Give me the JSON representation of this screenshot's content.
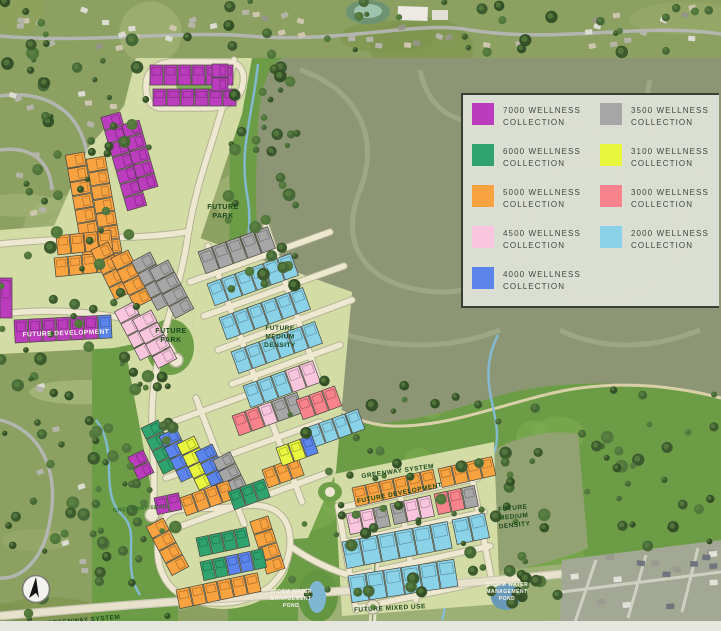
{
  "legend": {
    "items": [
      {
        "line1": "7000 WELLNESS",
        "line2": "COLLECTION",
        "color": "#bb3cbd"
      },
      {
        "line1": "6000 WELLNESS",
        "line2": "COLLECTION",
        "color": "#2fa36e"
      },
      {
        "line1": "5000 WELLNESS",
        "line2": "COLLECTION",
        "color": "#f9a240"
      },
      {
        "line1": "4500 WELLNESS",
        "line2": "COLLECTION",
        "color": "#f9c6de"
      },
      {
        "line1": "4000 WELLNESS",
        "line2": "COLLECTION",
        "color": "#5b85ec"
      },
      {
        "line1": "3500 WELLNESS",
        "line2": "COLLECTION",
        "color": "#a6a6a6"
      },
      {
        "line1": "3100 WELLNESS",
        "line2": "COLLECTION",
        "color": "#e8f73d"
      },
      {
        "line1": "3000 WELLNESS",
        "line2": "COLLECTION",
        "color": "#f9838c"
      },
      {
        "line1": "2000 WELLNESS",
        "line2": "COLLECTION",
        "color": "#8ad2e8"
      }
    ]
  },
  "map": {
    "palette": {
      "M": "#bb3cbd",
      "G": "#2fa36e",
      "O": "#f9a240",
      "P": "#f9c6de",
      "B": "#5b85ec",
      "A": "#a6a6a6",
      "Y": "#e8f73d",
      "S": "#f9838c",
      "C": "#8ad2e8"
    },
    "labels": [
      {
        "text": "FUTURE\nPARK",
        "x": 223,
        "y": 209,
        "size": 7,
        "color": "#1c4a1f",
        "rot": 0
      },
      {
        "text": "FUTURE\nPARK",
        "x": 171,
        "y": 333,
        "size": 7,
        "color": "#1c4a1f",
        "rot": 0
      },
      {
        "text": "FUTURE\nMEDIUM\nDENSITY",
        "x": 280,
        "y": 330,
        "size": 6.5,
        "color": "#1c4a1f",
        "rot": 0
      },
      {
        "text": "FUTURE DEVELOPMENT",
        "x": 66,
        "y": 335,
        "size": 6.5,
        "color": "#f7f4ee",
        "rot": -2
      },
      {
        "text": "GREENWAY SYSTEM",
        "x": 398,
        "y": 473,
        "size": 6.5,
        "color": "#1c4a1f",
        "rot": -8
      },
      {
        "text": "FUTURE DEVELOPMENT",
        "x": 400,
        "y": 495,
        "size": 6.5,
        "color": "#1c4a1f",
        "rot": -11
      },
      {
        "text": "FUTURE\nMEDIUM\nDENSITY",
        "x": 513,
        "y": 510,
        "size": 6.5,
        "color": "#1c4a1f",
        "rot": -6
      },
      {
        "text": "GREENWAY TRAIL",
        "x": 141,
        "y": 510,
        "size": 5.5,
        "color": "#2f6a2a",
        "rot": -4
      },
      {
        "text": "GREENWAY SYSTEM",
        "x": 84,
        "y": 622,
        "size": 6.5,
        "color": "#1c4a1f",
        "rot": -5
      },
      {
        "text": "STORM WATER\nMANAGEMENT\nPOND",
        "x": 291,
        "y": 593,
        "size": 5,
        "color": "#f7f4ee",
        "rot": 0
      },
      {
        "text": "FUTURE MIXED USE",
        "x": 390,
        "y": 610,
        "size": 6.5,
        "color": "#1c4a1f",
        "rot": -3
      },
      {
        "text": "STORM WATER\nMANAGEMENT\nPOND",
        "x": 507,
        "y": 586,
        "size": 5,
        "color": "#f7f4ee",
        "rot": 0
      }
    ],
    "strips": [
      {
        "x": 150,
        "y": 65,
        "a": 0,
        "n": 6,
        "w": 13,
        "h": 20,
        "c": [
          "M"
        ]
      },
      {
        "x": 153,
        "y": 89,
        "a": 0,
        "n": 6,
        "w": 13,
        "h": 17,
        "c": [
          "M"
        ]
      },
      {
        "x": 228,
        "y": 64,
        "a": 90,
        "n": 2,
        "w": 13,
        "h": 16,
        "c": [
          "M"
        ]
      },
      {
        "x": 120,
        "y": 112,
        "a": 74,
        "n": 7,
        "w": 13,
        "h": 20,
        "c": [
          "M"
        ]
      },
      {
        "x": 139,
        "y": 120,
        "a": 74,
        "n": 5,
        "w": 13,
        "h": 18,
        "c": [
          "M"
        ]
      },
      {
        "x": 84,
        "y": 152,
        "a": 80,
        "n": 8,
        "w": 13,
        "h": 19,
        "c": [
          "O"
        ]
      },
      {
        "x": 105,
        "y": 156,
        "a": 80,
        "n": 8,
        "w": 13,
        "h": 19,
        "c": [
          "O"
        ]
      },
      {
        "x": 56,
        "y": 236,
        "a": -6,
        "n": 4,
        "w": 13,
        "h": 19,
        "c": [
          "O"
        ]
      },
      {
        "x": 54,
        "y": 258,
        "a": -6,
        "n": 4,
        "w": 13,
        "h": 19,
        "c": [
          "O"
        ]
      },
      {
        "x": 108,
        "y": 242,
        "a": 64,
        "n": 4,
        "w": 13,
        "h": 19,
        "c": [
          "O"
        ]
      },
      {
        "x": 128,
        "y": 250,
        "a": 64,
        "n": 4,
        "w": 13,
        "h": 19,
        "c": [
          "O"
        ]
      },
      {
        "x": 14,
        "y": 320,
        "a": -3,
        "n": 7,
        "w": 13,
        "h": 23,
        "c": [
          "M",
          "M",
          "M",
          "M",
          "M",
          "M",
          "B"
        ]
      },
      {
        "x": 0,
        "y": 278,
        "a": 0,
        "n": 1,
        "w": 12,
        "h": 40,
        "c": [
          "M"
        ]
      },
      {
        "x": 150,
        "y": 252,
        "a": 62,
        "n": 4,
        "w": 13,
        "h": 21,
        "c": [
          "A"
        ]
      },
      {
        "x": 168,
        "y": 260,
        "a": 62,
        "n": 4,
        "w": 13,
        "h": 21,
        "c": [
          "A"
        ]
      },
      {
        "x": 133,
        "y": 302,
        "a": 62,
        "n": 4,
        "w": 13,
        "h": 21,
        "c": [
          "P"
        ]
      },
      {
        "x": 151,
        "y": 310,
        "a": 62,
        "n": 4,
        "w": 13,
        "h": 21,
        "c": [
          "P"
        ]
      },
      {
        "x": 198,
        "y": 252,
        "a": -20,
        "n": 5,
        "w": 14,
        "h": 23,
        "c": [
          "A"
        ]
      },
      {
        "x": 207,
        "y": 284,
        "a": -20,
        "n": 6,
        "w": 14,
        "h": 23,
        "c": [
          "C"
        ]
      },
      {
        "x": 219,
        "y": 318,
        "a": -20,
        "n": 6,
        "w": 14,
        "h": 23,
        "c": [
          "C"
        ]
      },
      {
        "x": 231,
        "y": 352,
        "a": -20,
        "n": 6,
        "w": 14,
        "h": 23,
        "c": [
          "C"
        ]
      },
      {
        "x": 243,
        "y": 386,
        "a": -20,
        "n": 5,
        "w": 14,
        "h": 23,
        "c": [
          "C",
          "C",
          "C",
          "P",
          "P"
        ]
      },
      {
        "x": 232,
        "y": 416,
        "a": -20,
        "n": 5,
        "w": 13,
        "h": 21,
        "c": [
          "S",
          "S",
          "P",
          "A",
          "A"
        ]
      },
      {
        "x": 296,
        "y": 400,
        "a": -20,
        "n": 3,
        "w": 13,
        "h": 21,
        "c": [
          "S"
        ]
      },
      {
        "x": 306,
        "y": 428,
        "a": -20,
        "n": 4,
        "w": 13,
        "h": 21,
        "c": [
          "C"
        ]
      },
      {
        "x": 158,
        "y": 420,
        "a": 64,
        "n": 4,
        "w": 12,
        "h": 19,
        "c": [
          "G"
        ]
      },
      {
        "x": 176,
        "y": 428,
        "a": 64,
        "n": 4,
        "w": 12,
        "h": 19,
        "c": [
          "B"
        ]
      },
      {
        "x": 194,
        "y": 436,
        "a": 64,
        "n": 4,
        "w": 12,
        "h": 19,
        "c": [
          "Y"
        ]
      },
      {
        "x": 212,
        "y": 444,
        "a": 64,
        "n": 4,
        "w": 12,
        "h": 19,
        "c": [
          "B"
        ]
      },
      {
        "x": 230,
        "y": 452,
        "a": 64,
        "n": 4,
        "w": 12,
        "h": 19,
        "c": [
          "A"
        ]
      },
      {
        "x": 143,
        "y": 450,
        "a": 64,
        "n": 2,
        "w": 12,
        "h": 17,
        "c": [
          "M"
        ]
      },
      {
        "x": 180,
        "y": 498,
        "a": -20,
        "n": 4,
        "w": 12,
        "h": 19,
        "c": [
          "O"
        ]
      },
      {
        "x": 228,
        "y": 492,
        "a": -20,
        "n": 3,
        "w": 12,
        "h": 19,
        "c": [
          "G"
        ]
      },
      {
        "x": 262,
        "y": 470,
        "a": -20,
        "n": 3,
        "w": 12,
        "h": 19,
        "c": [
          "O"
        ]
      },
      {
        "x": 276,
        "y": 448,
        "a": -20,
        "n": 3,
        "w": 12,
        "h": 19,
        "c": [
          "Y",
          "Y",
          "B"
        ]
      },
      {
        "x": 163,
        "y": 518,
        "a": 62,
        "n": 4,
        "w": 13,
        "h": 19,
        "c": [
          "O"
        ]
      },
      {
        "x": 176,
        "y": 590,
        "a": -12,
        "n": 6,
        "w": 13,
        "h": 19,
        "c": [
          "O"
        ]
      },
      {
        "x": 268,
        "y": 516,
        "a": 72,
        "n": 4,
        "w": 13,
        "h": 19,
        "c": [
          "O"
        ]
      },
      {
        "x": 196,
        "y": 538,
        "a": -12,
        "n": 4,
        "w": 12,
        "h": 19,
        "c": [
          "G"
        ]
      },
      {
        "x": 200,
        "y": 562,
        "a": -12,
        "n": 5,
        "w": 12,
        "h": 19,
        "c": [
          "G",
          "G",
          "B",
          "B",
          "G"
        ]
      },
      {
        "x": 154,
        "y": 498,
        "a": -12,
        "n": 2,
        "w": 12,
        "h": 17,
        "c": [
          "M"
        ]
      },
      {
        "x": 352,
        "y": 488,
        "a": -13,
        "n": 6,
        "w": 13,
        "h": 19,
        "c": [
          "O"
        ]
      },
      {
        "x": 438,
        "y": 469,
        "a": -13,
        "n": 4,
        "w": 13,
        "h": 19,
        "c": [
          "O"
        ]
      },
      {
        "x": 346,
        "y": 514,
        "a": -12,
        "n": 3,
        "w": 13,
        "h": 21,
        "c": [
          "P",
          "P",
          "A"
        ]
      },
      {
        "x": 390,
        "y": 504,
        "a": -12,
        "n": 3,
        "w": 13,
        "h": 21,
        "c": [
          "A",
          "P",
          "P"
        ]
      },
      {
        "x": 434,
        "y": 494,
        "a": -12,
        "n": 3,
        "w": 13,
        "h": 21,
        "c": [
          "S",
          "S",
          "A"
        ]
      },
      {
        "x": 342,
        "y": 542,
        "a": -11,
        "n": 6,
        "w": 17,
        "h": 27,
        "c": [
          "C"
        ]
      },
      {
        "x": 348,
        "y": 576,
        "a": -9,
        "n": 6,
        "w": 17,
        "h": 27,
        "c": [
          "C"
        ]
      },
      {
        "x": 452,
        "y": 520,
        "a": -12,
        "n": 2,
        "w": 16,
        "h": 25,
        "c": [
          "C"
        ]
      }
    ]
  }
}
